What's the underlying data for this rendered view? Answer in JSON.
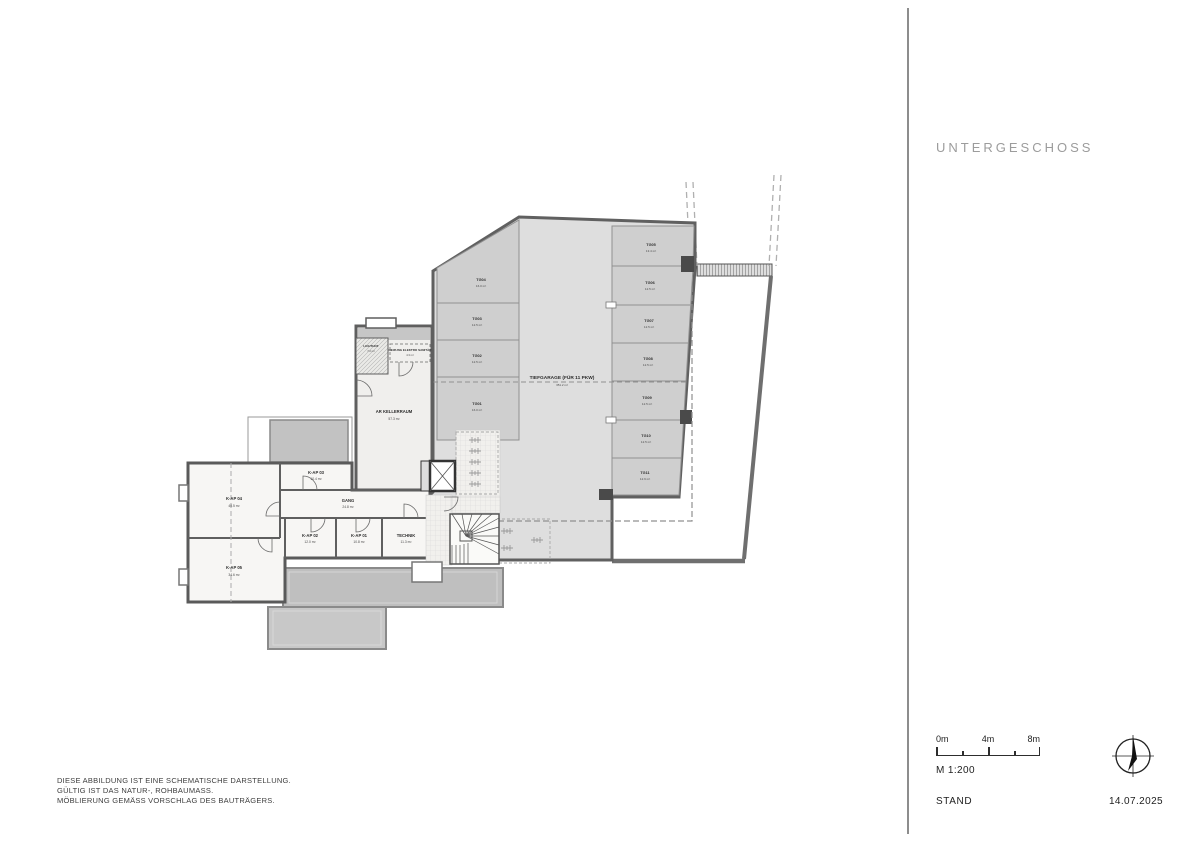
{
  "header": {
    "title": "UNTERGESCHOSS"
  },
  "footer": {
    "scale_label": "M 1:200",
    "stand_label": "STAND",
    "date": "14.07.2025",
    "scalebar": {
      "m0": "0m",
      "m4": "4m",
      "m8": "8m"
    }
  },
  "disclaimer": {
    "line1": "DIESE ABBILDUNG IST EINE SCHEMATISCHE DARSTELLUNG.",
    "line2": "GÜLTIG IST DAS NATUR-, ROHBAUMASS.",
    "line3": "MÖBLIERUNG GEMÄSS VORSCHLAG DES BAUTRÄGERS."
  },
  "plan": {
    "garage": {
      "label": "TIEFGARAGE (FÜR 11 PKW)",
      "area": "351.2 m²"
    },
    "stalls": [
      {
        "id": "TG01",
        "area": "16.0 m²"
      },
      {
        "id": "TG02",
        "area": "12.5 m²"
      },
      {
        "id": "TG03",
        "area": "12.5 m²"
      },
      {
        "id": "TG04",
        "area": "16.0 m²"
      },
      {
        "id": "TG05",
        "area": "13.4 m²"
      },
      {
        "id": "TG06",
        "area": "12.5 m²"
      },
      {
        "id": "TG07",
        "area": "12.5 m²"
      },
      {
        "id": "TG08",
        "area": "12.5 m²"
      },
      {
        "id": "TG09",
        "area": "12.5 m²"
      },
      {
        "id": "TG10",
        "area": "12.5 m²"
      },
      {
        "id": "TG11",
        "area": "12.9 m²"
      }
    ],
    "rooms": {
      "kap01": {
        "label": "K-AP 01",
        "area": "10.8 m²"
      },
      "kap02": {
        "label": "K-AP 02",
        "area": "12.0 m²"
      },
      "kap03": {
        "label": "K-AP 03",
        "area": "10.4 m²"
      },
      "kap04": {
        "label": "K-AP 04",
        "area": "40.5 m²"
      },
      "kap05": {
        "label": "K-AP 05",
        "area": "34.6 m²"
      },
      "technik": {
        "label": "TECHNIK",
        "area": "11.3 m²"
      },
      "gang": {
        "label": "GANG",
        "area": "24.8 m²"
      },
      "kellerraum": {
        "label": "AR KELLERRAUM",
        "area": "57.3 m²"
      },
      "lichthof": {
        "label": "LICHTHOF",
        "area": "7.2 m²"
      },
      "hausanschluss": {
        "label": "HEIZUNG ELEKTRO SANITÄR",
        "area": "4.3 m²"
      }
    }
  }
}
